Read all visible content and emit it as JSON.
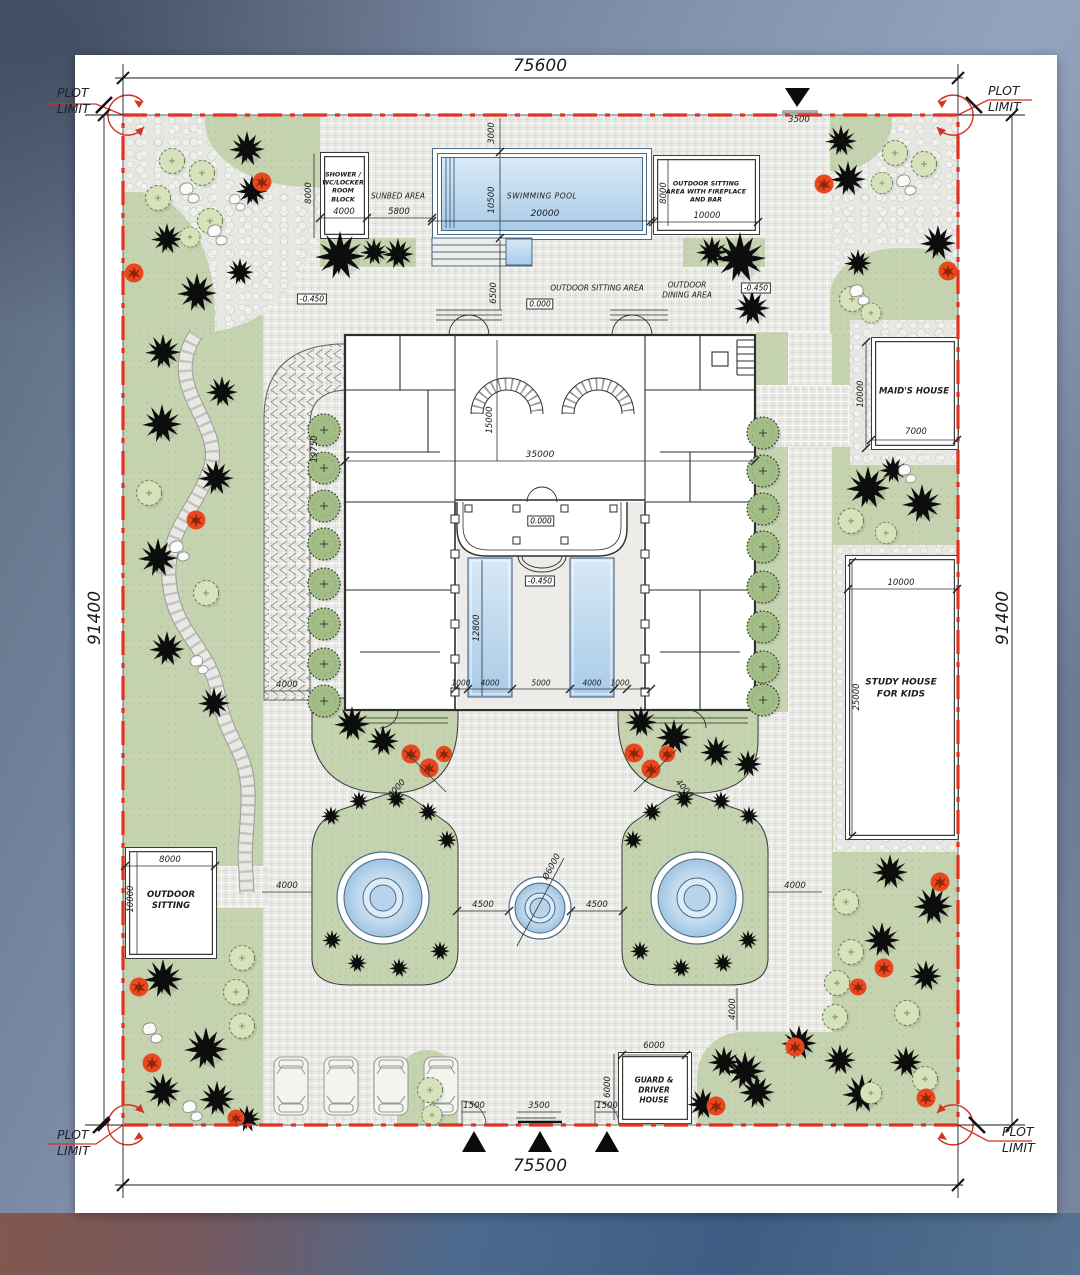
{
  "plot_limit": [
    "PLOT",
    "LIMIT"
  ],
  "dims": {
    "plot_top": "75600",
    "plot_bottom": "75500",
    "plot_side": "91400",
    "gate_top": "3500",
    "gate_small": "1500",
    "gate_main": "3500",
    "pool_offset": "3000",
    "pool_width": "10500",
    "pool_length": "20000",
    "sunbed_w": "5800",
    "shower_w": "4000",
    "shower_h": "8000",
    "fire_h": "8000",
    "fire_w": "10000",
    "court_gap": "6500",
    "pergola_len": "19750",
    "pergola_w": "4000",
    "hall_depth": "15000",
    "house_w": "35000",
    "rp_len": "12800",
    "court_row": [
      "1000",
      "4000",
      "5000",
      "4000",
      "1000"
    ],
    "maid_h": "10000",
    "maid_w": "7000",
    "study_w": "10000",
    "study_h": "25000",
    "sit_w": "8000",
    "sit_h": "10000",
    "walk": "4000",
    "island_gap": "4500",
    "fountain_dia": "Ø6000",
    "guard_w": "6000",
    "guard_h": "6000"
  },
  "levels": {
    "zero": "0.000",
    "minus": "-0.450"
  },
  "labels": {
    "shower": [
      "SHOWER /",
      "WC/LOCKER",
      "ROOM",
      "BLOCK"
    ],
    "sunbed": "SUNBED AREA",
    "pool": "SWIMMING POOL",
    "fire": [
      "OUTDOOR SITTING",
      "AREA WITH FIREPLACE",
      "AND BAR"
    ],
    "sitting_area": "OUTDOOR SITTING AREA",
    "dining": [
      "OUTDOOR",
      "DINING AREA"
    ],
    "maid": "MAID'S HOUSE",
    "study": [
      "STUDY HOUSE",
      "FOR KIDS"
    ],
    "outdoor_sitting": [
      "OUTDOOR",
      "SITTING"
    ],
    "guard": [
      "GUARD &",
      "DRIVER",
      "HOUSE"
    ]
  }
}
